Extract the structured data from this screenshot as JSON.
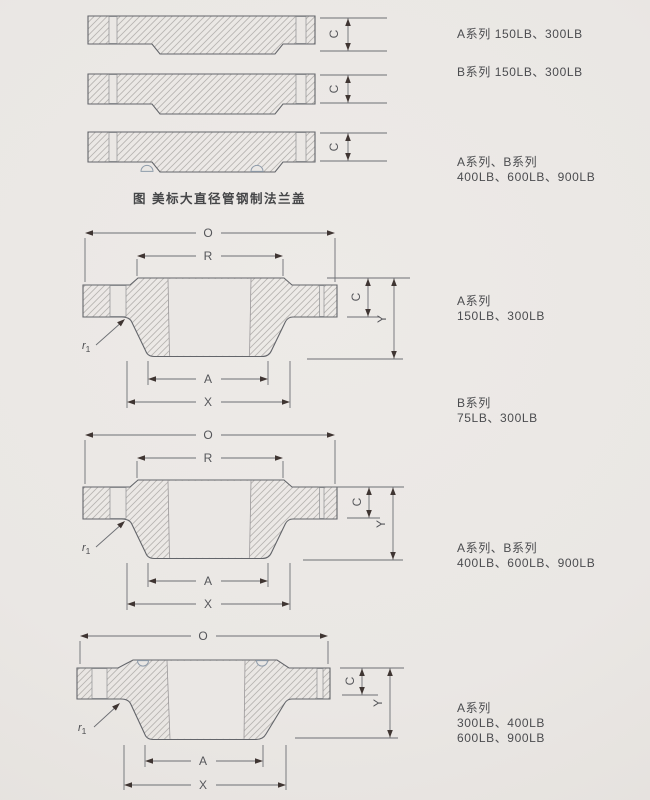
{
  "figure": {
    "caption": "图 美标大直径管钢制法兰盖"
  },
  "dim_labels": {
    "O": "O",
    "R": "R",
    "A": "A",
    "X": "X",
    "C": "C",
    "Y": "Y",
    "r": "r",
    "r_sub": "1"
  },
  "series_labels": {
    "top_view1": "A系列 150LB、300LB",
    "top_view2": "B系列 150LB、300LB",
    "top_view3_line1": "A系列、B系列",
    "top_view3_line2": "400LB、600LB、900LB",
    "mid_a_line1": "A系列",
    "mid_a_line2": "150LB、300LB",
    "mid_b_line1": "B系列",
    "mid_b_line2": "75LB、300LB",
    "lower_line1": "A系列、B系列",
    "lower_line2": "400LB、600LB、900LB",
    "bottom_line1": "A系列",
    "bottom_line2": "300LB、400LB",
    "bottom_line3": "600LB、900LB"
  },
  "colors": {
    "background": "#eae7e4",
    "outline": "#63656a",
    "dimension_line": "#6d6f74",
    "hatch": "#b7b4b1",
    "arrow": "#3f3532",
    "text": "#4b4c4f",
    "groove_arc": "#8f9cab"
  }
}
